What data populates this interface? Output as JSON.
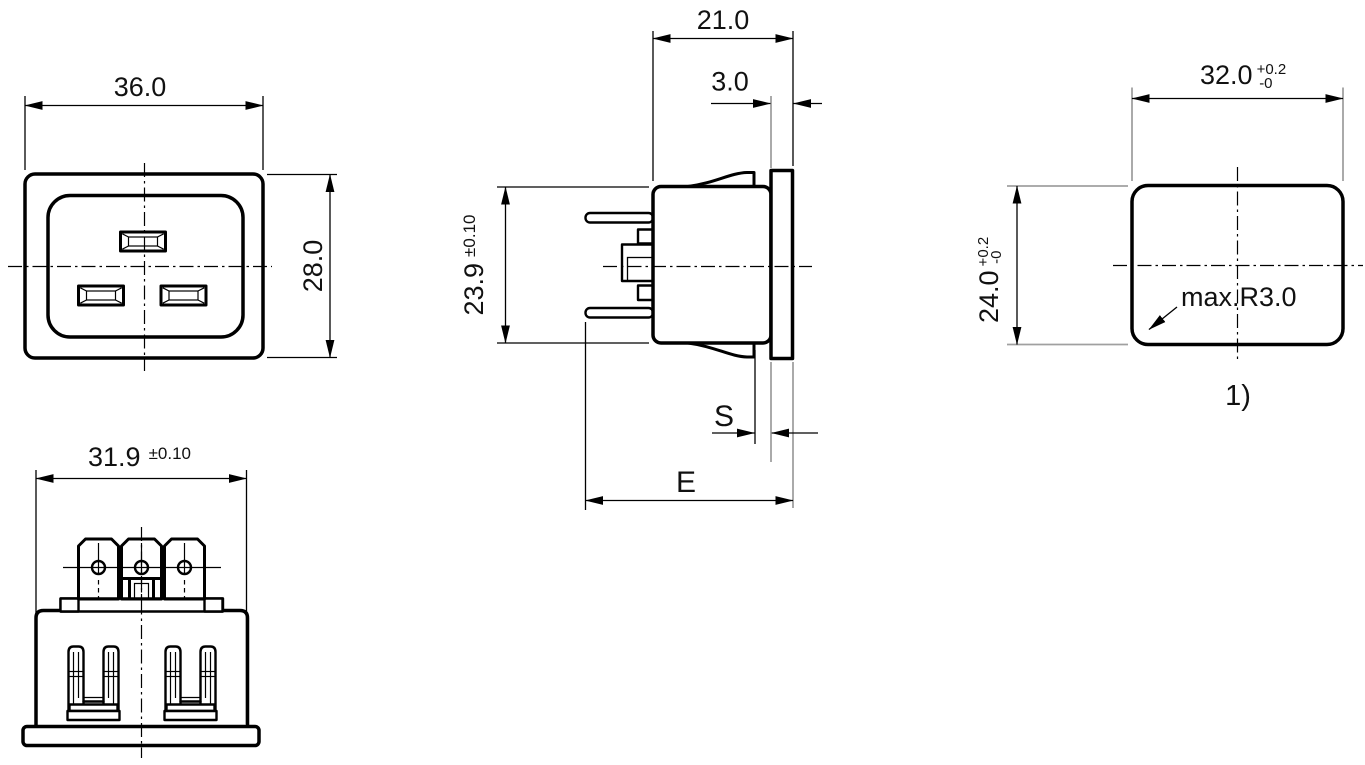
{
  "front_view": {
    "width": "36.0",
    "height": "28.0"
  },
  "rear_view": {
    "width": "31.9",
    "width_tolerance": "±0.10"
  },
  "side_view": {
    "depth": "21.0",
    "flange_thickness": "3.0",
    "height": "23.9",
    "height_tolerance": "±0.10",
    "panel_thickness_label": "S",
    "depth_label": "E"
  },
  "cutout_view": {
    "width": "32.0",
    "width_tol_upper": "+0.2",
    "width_tol_lower": "-0",
    "height": "24.0",
    "height_tol_upper": "+0.2",
    "height_tol_lower": "-0",
    "corner_radius_note": "max.R3.0",
    "footnote_marker": "1)"
  }
}
